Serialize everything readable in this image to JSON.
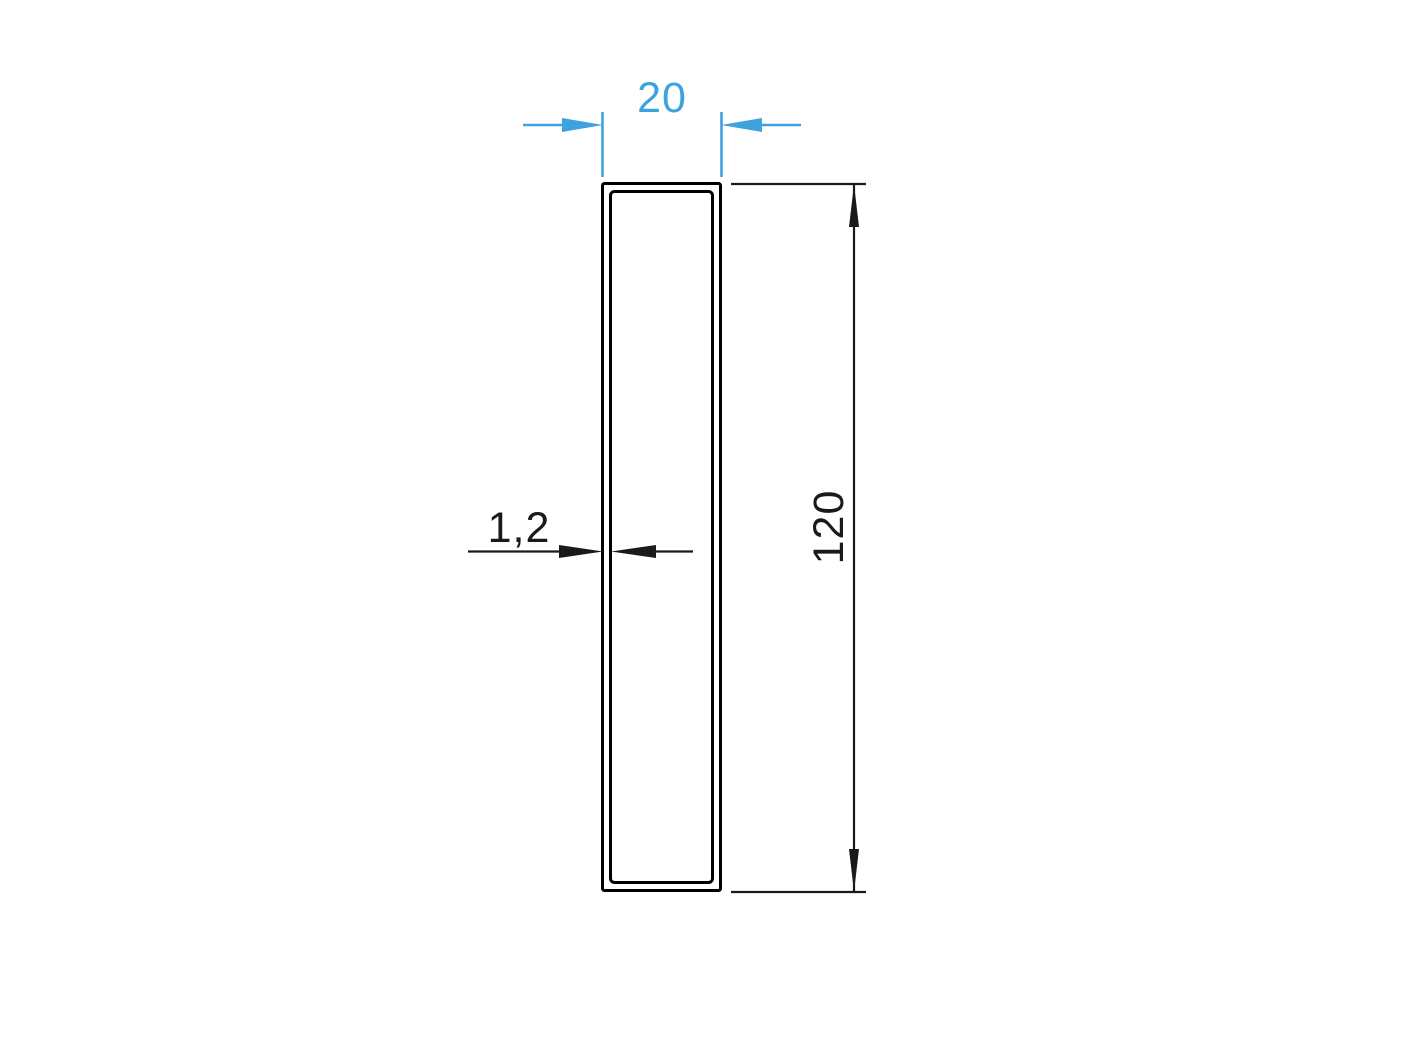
{
  "dimensions": {
    "width": {
      "label": "20"
    },
    "height": {
      "label": "120"
    },
    "wall_thickness": {
      "label": "1,2"
    }
  },
  "colors": {
    "width_dimension": "#3EA2DC",
    "height_dimension": "#1A1A1A",
    "wall_thickness_dimension": "#1A1A1A",
    "profile_outline": "#000000",
    "background": "#FFFFFF"
  }
}
